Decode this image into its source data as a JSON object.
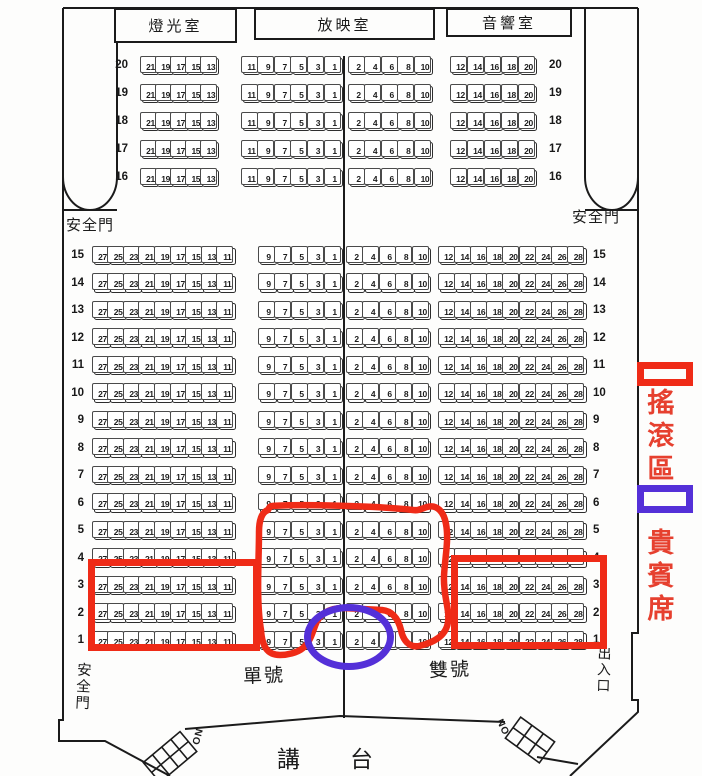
{
  "rooms": [
    {
      "label": "燈光室"
    },
    {
      "label": "放映室"
    },
    {
      "label": "音響室"
    }
  ],
  "exit_labels": {
    "top_left": "安全門",
    "top_right": "安全門",
    "bottom_left": "安全門",
    "bottom_right": "出入口"
  },
  "aisle_labels": {
    "odd_side": "單號",
    "even_side": "雙號"
  },
  "stage": {
    "char_1": "講",
    "char_2": "台"
  },
  "stair_labels": {
    "left": "ON",
    "right": "NO"
  },
  "legend": [
    {
      "label": "搖滾區",
      "swatch_color": "#ef2b17"
    },
    {
      "label": "貴賓席",
      "swatch_color": "#5430d8"
    }
  ],
  "upper_section": {
    "row_numbers": [
      20,
      19,
      18,
      17,
      16
    ],
    "left_seats": [
      21,
      19,
      17,
      15,
      13
    ],
    "center_left_seats": [
      11,
      9,
      7,
      5,
      3,
      1
    ],
    "center_right_seats": [
      2,
      4,
      6,
      8,
      10
    ],
    "right_seats": [
      12,
      14,
      16,
      18,
      20
    ]
  },
  "main_section": {
    "row_numbers": [
      15,
      14,
      13,
      12,
      11,
      10,
      9,
      8,
      7,
      6,
      5,
      4,
      3,
      2,
      1
    ],
    "left_seats": [
      27,
      25,
      23,
      21,
      19,
      17,
      15,
      13,
      11
    ],
    "center_left_seats": [
      9,
      7,
      5,
      3,
      1
    ],
    "center_right_seats": [
      2,
      4,
      6,
      8,
      10
    ],
    "right_seats": [
      12,
      14,
      16,
      18,
      20,
      22,
      24,
      26,
      28
    ]
  },
  "colors": {
    "annotation_red": "#ef2b17",
    "annotation_blue": "#5430d8",
    "legend_text_red": "#e6402f",
    "ink": "#1b1b1b"
  }
}
